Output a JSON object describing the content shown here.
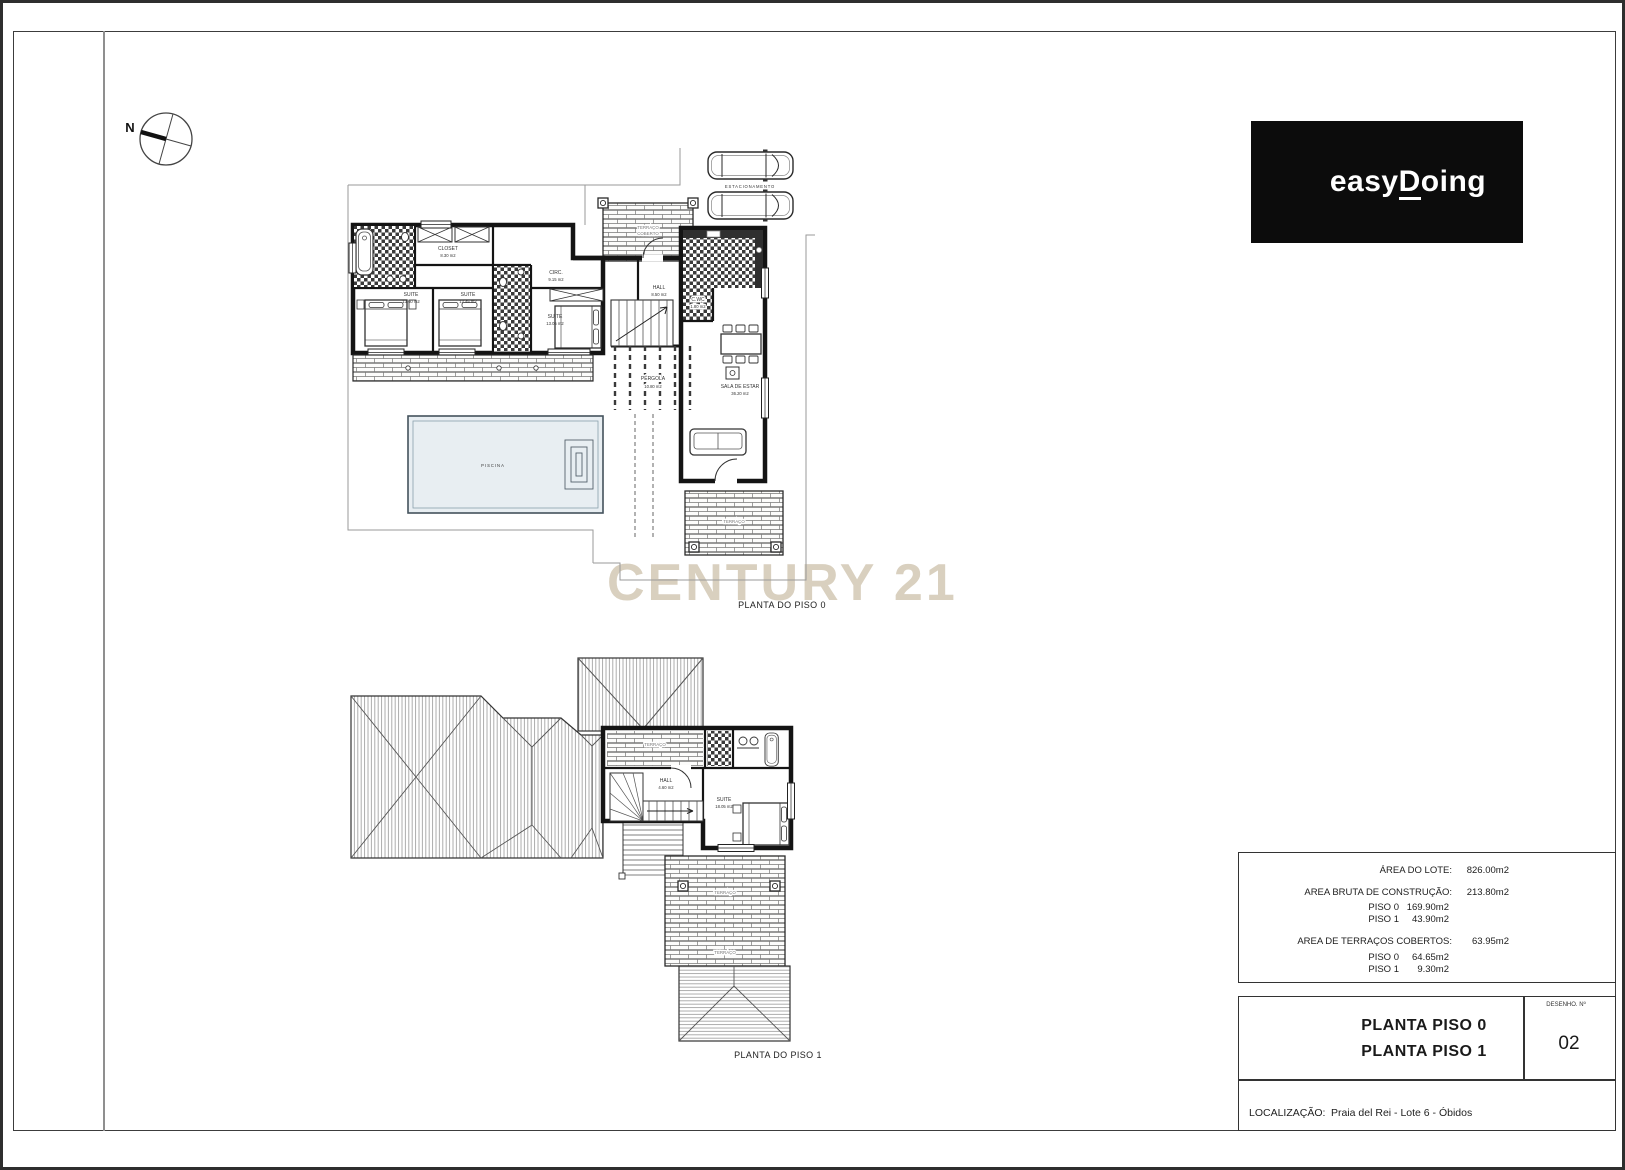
{
  "sheet": {
    "compass_n": "N",
    "watermark": "CENTURY 21",
    "logo": {
      "part1": "easy",
      "part2": "D",
      "part3": "oing",
      "bg": "#0c0c0c",
      "fg": "#ffffff"
    }
  },
  "plan0": {
    "caption": "PLANTA DO PISO 0",
    "parking": "ESTACIONAMENTO",
    "pool": "PISCINA",
    "terrace_word1": "TERRAÇO",
    "terrace_word2": "COBERTO",
    "rooms": {
      "closet": {
        "n": "CLOSET",
        "a": "8.30 m2"
      },
      "suite1": {
        "n": "SUITE",
        "a": "13.60 m2"
      },
      "suite2": {
        "n": "SUITE",
        "a": "12.45 m2"
      },
      "suite3": {
        "n": "SUITE",
        "a": "13.05 m2"
      },
      "circ": {
        "n": "CIRC.",
        "a": "9.15 m2"
      },
      "hall": {
        "n": "HALL",
        "a": "8.50 m2"
      },
      "cwc": {
        "n": "C.WC",
        "a": "1.80 m2"
      },
      "pergola": {
        "n": "PÉRGOLA",
        "a": "10.80 m2"
      },
      "sala": {
        "n": "SALA DE ESTAR",
        "a": "36.20 m2"
      }
    }
  },
  "plan1": {
    "caption": "PLANTA DO PISO 1",
    "terrace_word": "TERRAÇO",
    "rooms": {
      "hall": {
        "n": "HALL",
        "a": "4.60 m2"
      },
      "suite": {
        "n": "SUITE",
        "a": "18.05 m2"
      }
    }
  },
  "area_table": {
    "rows": [
      {
        "label": "ÁREA DO LOTE:",
        "value": "826.00m2"
      },
      {
        "label": "AREA BRUTA DE CONSTRUÇÃO:",
        "value": "213.80m2"
      },
      {
        "label": "PISO 0",
        "value": "169.90m2"
      },
      {
        "label": "PISO 1",
        "value": "43.90m2"
      },
      {
        "label": "AREA DE TERRAÇOS COBERTOS:",
        "value": "63.95m2"
      },
      {
        "label": "PISO 0",
        "value": "64.65m2"
      },
      {
        "label": "PISO 1",
        "value": "9.30m2"
      }
    ]
  },
  "title_block": {
    "line1": "PLANTA PISO 0",
    "line2": "PLANTA PISO 1",
    "drawing_no_label": "DESENHO. Nº",
    "drawing_no": "02"
  },
  "location": {
    "label": "LOCALIZAÇÃO:",
    "value": "Praia del Rei - Lote 6 - Óbidos"
  }
}
